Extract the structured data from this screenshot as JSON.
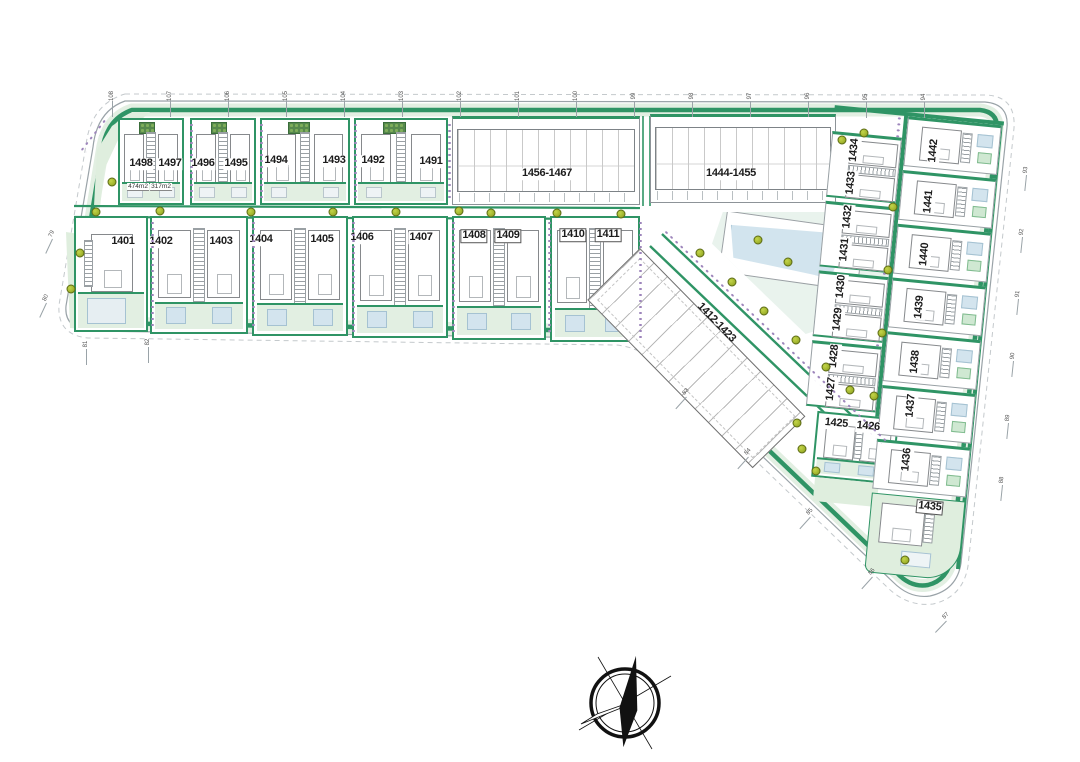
{
  "labels": {
    "l1401": "1401",
    "l1402": "1402",
    "l1403": "1403",
    "l1404": "1404",
    "l1405": "1405",
    "l1406": "1406",
    "l1407": "1407",
    "l1408": "1408",
    "l1409": "1409",
    "l1410": "1410",
    "l1411": "1411",
    "l1425": "1425",
    "l1426": "1426",
    "l1427": "1427",
    "l1428": "1428",
    "l1429": "1429",
    "l1430": "1430",
    "l1431": "1431",
    "l1432": "1432",
    "l1433": "1433",
    "l1434": "1434",
    "l1435": "1435",
    "l1436": "1436",
    "l1437": "1437",
    "l1438": "1438",
    "l1439": "1439",
    "l1440": "1440",
    "l1441": "1441",
    "l1442": "1442",
    "l1491": "1491",
    "l1492": "1492",
    "l1493": "1493",
    "l1494": "1494",
    "l1495": "1495",
    "l1496": "1496",
    "l1497": "1497",
    "l1498": "1498"
  },
  "blocks": {
    "a": "1456-1467",
    "b": "1444-1455",
    "diag": "1412-1423"
  },
  "areas": {
    "a474": "474m2",
    "a317": "317m2"
  },
  "colors": {
    "hedge": "#2f9465",
    "garden": "#e2efe2",
    "pool": "#d3e4ee",
    "shrub": "#9d85bb",
    "tree": "#a2b52e"
  },
  "ticks": [
    {
      "t": "108",
      "x": 112,
      "y": 96,
      "r": -90
    },
    {
      "t": "107",
      "x": 170,
      "y": 96,
      "r": -90
    },
    {
      "t": "106",
      "x": 228,
      "y": 96,
      "r": -90
    },
    {
      "t": "105",
      "x": 286,
      "y": 96,
      "r": -90
    },
    {
      "t": "104",
      "x": 344,
      "y": 96,
      "r": -90
    },
    {
      "t": "103",
      "x": 402,
      "y": 96,
      "r": -90
    },
    {
      "t": "102",
      "x": 460,
      "y": 96,
      "r": -90
    },
    {
      "t": "101",
      "x": 518,
      "y": 96,
      "r": -90
    },
    {
      "t": "100",
      "x": 576,
      "y": 96,
      "r": -90
    },
    {
      "t": "99",
      "x": 634,
      "y": 96,
      "r": -90
    },
    {
      "t": "98",
      "x": 692,
      "y": 96,
      "r": -90
    },
    {
      "t": "97",
      "x": 750,
      "y": 96,
      "r": -90
    },
    {
      "t": "96",
      "x": 808,
      "y": 96,
      "r": -90
    },
    {
      "t": "95",
      "x": 866,
      "y": 97,
      "r": -90
    },
    {
      "t": "94",
      "x": 924,
      "y": 97,
      "r": -90
    },
    {
      "t": "93",
      "x": 1026,
      "y": 170,
      "r": -84
    },
    {
      "t": "92",
      "x": 1022,
      "y": 232,
      "r": -84
    },
    {
      "t": "91",
      "x": 1018,
      "y": 294,
      "r": -84
    },
    {
      "t": "90",
      "x": 1013,
      "y": 356,
      "r": -84
    },
    {
      "t": "89",
      "x": 1008,
      "y": 418,
      "r": -84
    },
    {
      "t": "88",
      "x": 1002,
      "y": 480,
      "r": -84
    },
    {
      "t": "87",
      "x": 946,
      "y": 616,
      "r": -46
    },
    {
      "t": "86",
      "x": 872,
      "y": 572,
      "r": -48
    },
    {
      "t": "85",
      "x": 810,
      "y": 512,
      "r": -48
    },
    {
      "t": "84",
      "x": 748,
      "y": 452,
      "r": -48
    },
    {
      "t": "83",
      "x": 686,
      "y": 392,
      "r": -48
    },
    {
      "t": "82",
      "x": 148,
      "y": 342,
      "r": -90
    },
    {
      "t": "81",
      "x": 86,
      "y": 344,
      "r": -90
    },
    {
      "t": "80",
      "x": 46,
      "y": 298,
      "r": -65
    },
    {
      "t": "79",
      "x": 52,
      "y": 234,
      "r": -65
    }
  ]
}
